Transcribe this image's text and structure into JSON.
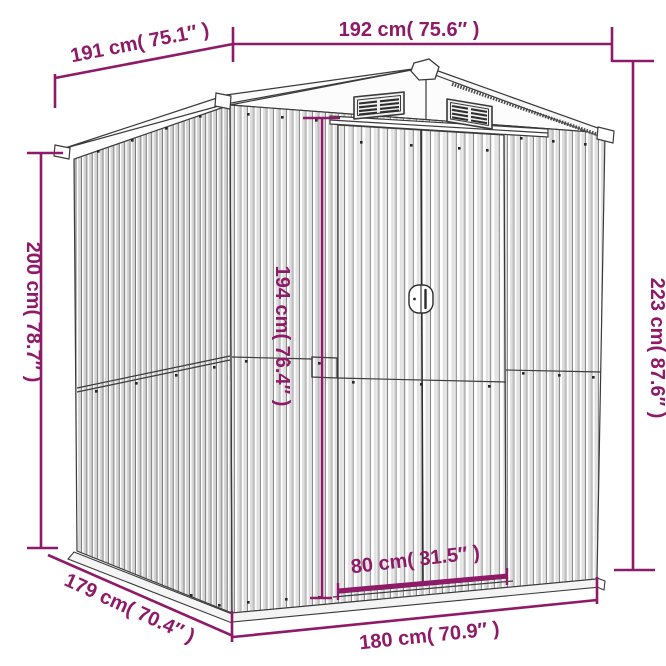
{
  "colors": {
    "dimension": "#8e1a68",
    "outline": "#3a3a3a",
    "background": "#ffffff"
  },
  "dims": {
    "depth_top": {
      "cm": 191,
      "inches": 75.1,
      "label": "191 cm( 75.1″ )"
    },
    "width_top": {
      "cm": 192,
      "inches": 75.6,
      "label": "192 cm( 75.6″ )"
    },
    "wall_height": {
      "cm": 200,
      "inches": 78.7,
      "label": "200 cm( 78.7″ )"
    },
    "total_height": {
      "cm": 223,
      "inches": 87.6,
      "label": "223 cm( 87.6″ )"
    },
    "door_height": {
      "cm": 194,
      "inches": 76.4,
      "label": "194 cm( 76.4″ )"
    },
    "door_width": {
      "cm": 80,
      "inches": 31.5,
      "label": "80 cm( 31.5″ )"
    },
    "depth_bottom": {
      "cm": 179,
      "inches": 70.4,
      "label": "179 cm( 70.4″ )"
    },
    "width_bottom": {
      "cm": 180,
      "inches": 70.9,
      "label": "180 cm( 70.9″ )"
    }
  }
}
